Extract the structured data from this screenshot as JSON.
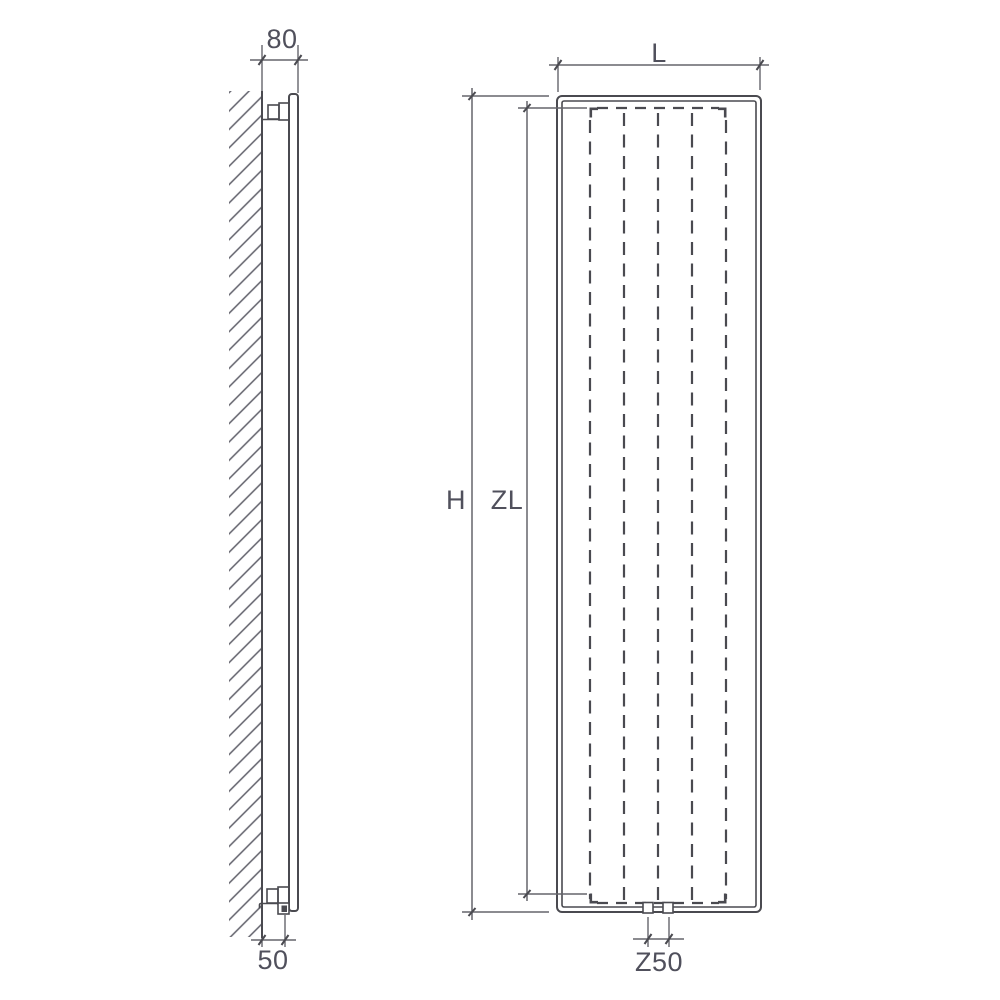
{
  "drawing": {
    "type": "radiator-technical-drawing",
    "colors": {
      "line": "#4a4a50",
      "ext": "#65656b",
      "text": "#50505c",
      "background": "#ffffff"
    },
    "side_view": {
      "dim_depth_from_wall": "80",
      "dim_bottom_connection_offset": "50"
    },
    "front_view": {
      "dim_width": "L",
      "dim_total_height": "H",
      "dim_element_height": "ZL",
      "dim_connection_spacing": "Z50",
      "fin_count": 5,
      "connector_count": 2
    }
  }
}
